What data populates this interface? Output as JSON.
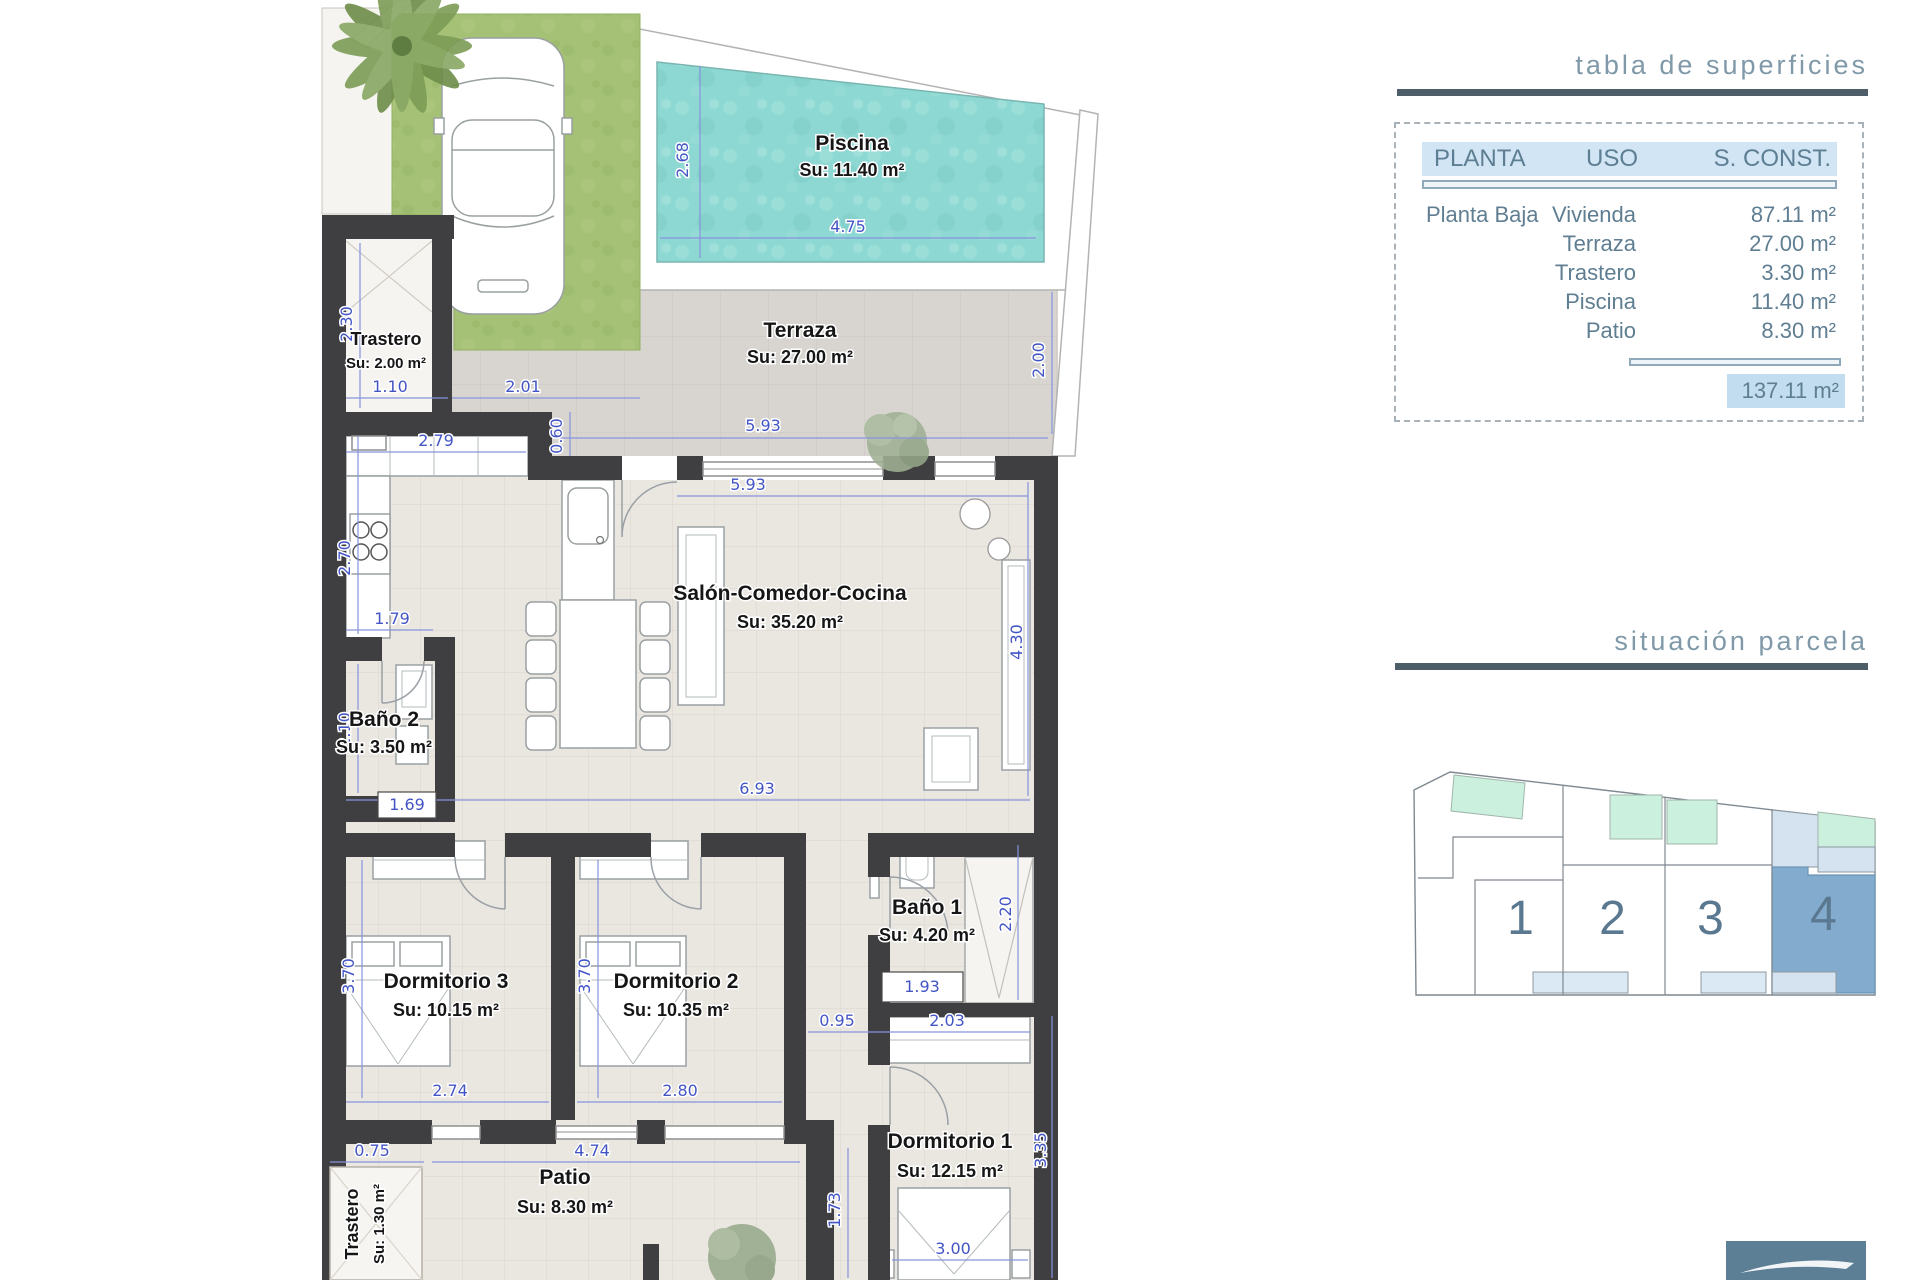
{
  "surfaces_table": {
    "title": "tabla de superficies",
    "headers": {
      "planta": "PLANTA",
      "uso": "USO",
      "sconst": "S. CONST."
    },
    "rows": [
      {
        "planta": "Planta Baja",
        "uso": "Vivienda",
        "value": "87.11 m²"
      },
      {
        "planta": "",
        "uso": "Terraza",
        "value": "27.00 m²"
      },
      {
        "planta": "",
        "uso": "Trastero",
        "value": "3.30 m²"
      },
      {
        "planta": "",
        "uso": "Piscina",
        "value": "11.40 m²"
      },
      {
        "planta": "",
        "uso": "Patio",
        "value": "8.30 m²"
      }
    ],
    "total": "137.11 m²"
  },
  "parcel": {
    "title": "situación parcela",
    "plots": [
      "1",
      "2",
      "3",
      "4"
    ],
    "highlighted_plot": "4"
  },
  "plan": {
    "rooms": [
      {
        "name": "Piscina",
        "area": "Su: 11.40 m²"
      },
      {
        "name": "Terraza",
        "area": "Su: 27.00 m²"
      },
      {
        "name": "Trastero",
        "area": "Su: 2.00 m²"
      },
      {
        "name": "Salón-Comedor-Cocina",
        "area": "Su: 35.20 m²"
      },
      {
        "name": "Baño 2",
        "area": "Su: 3.50 m²"
      },
      {
        "name": "Dormitorio 3",
        "area": "Su: 10.15 m²"
      },
      {
        "name": "Dormitorio 2",
        "area": "Su: 10.35 m²"
      },
      {
        "name": "Baño 1",
        "area": "Su: 4.20 m²"
      },
      {
        "name": "Dormitorio 1",
        "area": "Su: 12.15 m²"
      },
      {
        "name": "Patio",
        "area": "Su: 8.30 m²"
      },
      {
        "name": "Trastero",
        "area": "Su: 1.30 m²"
      }
    ],
    "dims": [
      "2.68",
      "4.75",
      "2.30",
      "1.10",
      "2.01",
      "0.60",
      "5.93",
      "2.00",
      "2.79",
      "5.93",
      "2.70",
      "1.79",
      "2.10",
      "1.69",
      "6.93",
      "4.30",
      "3.70",
      "3.70",
      "2.74",
      "2.80",
      "0.95",
      "2.03",
      "1.93",
      "2.20",
      "3.35",
      "0.75",
      "4.74",
      "1.73",
      "3.00"
    ]
  },
  "colors": {
    "wall": "#3f3f41",
    "pool": "#8ed8d3",
    "grass": "#a5c175",
    "dim_blue": "#4355c5",
    "heading_text": "#7f99a9",
    "rule": "#4e5e69",
    "table_header_bg": "#d2e5f4",
    "total_bg": "#c3ddf0",
    "plot_highlight": "#82abce",
    "plot_light": "#d5e3f0",
    "plot_pool_mint": "#ccf0de",
    "logo_bg": "#5d7f96"
  }
}
